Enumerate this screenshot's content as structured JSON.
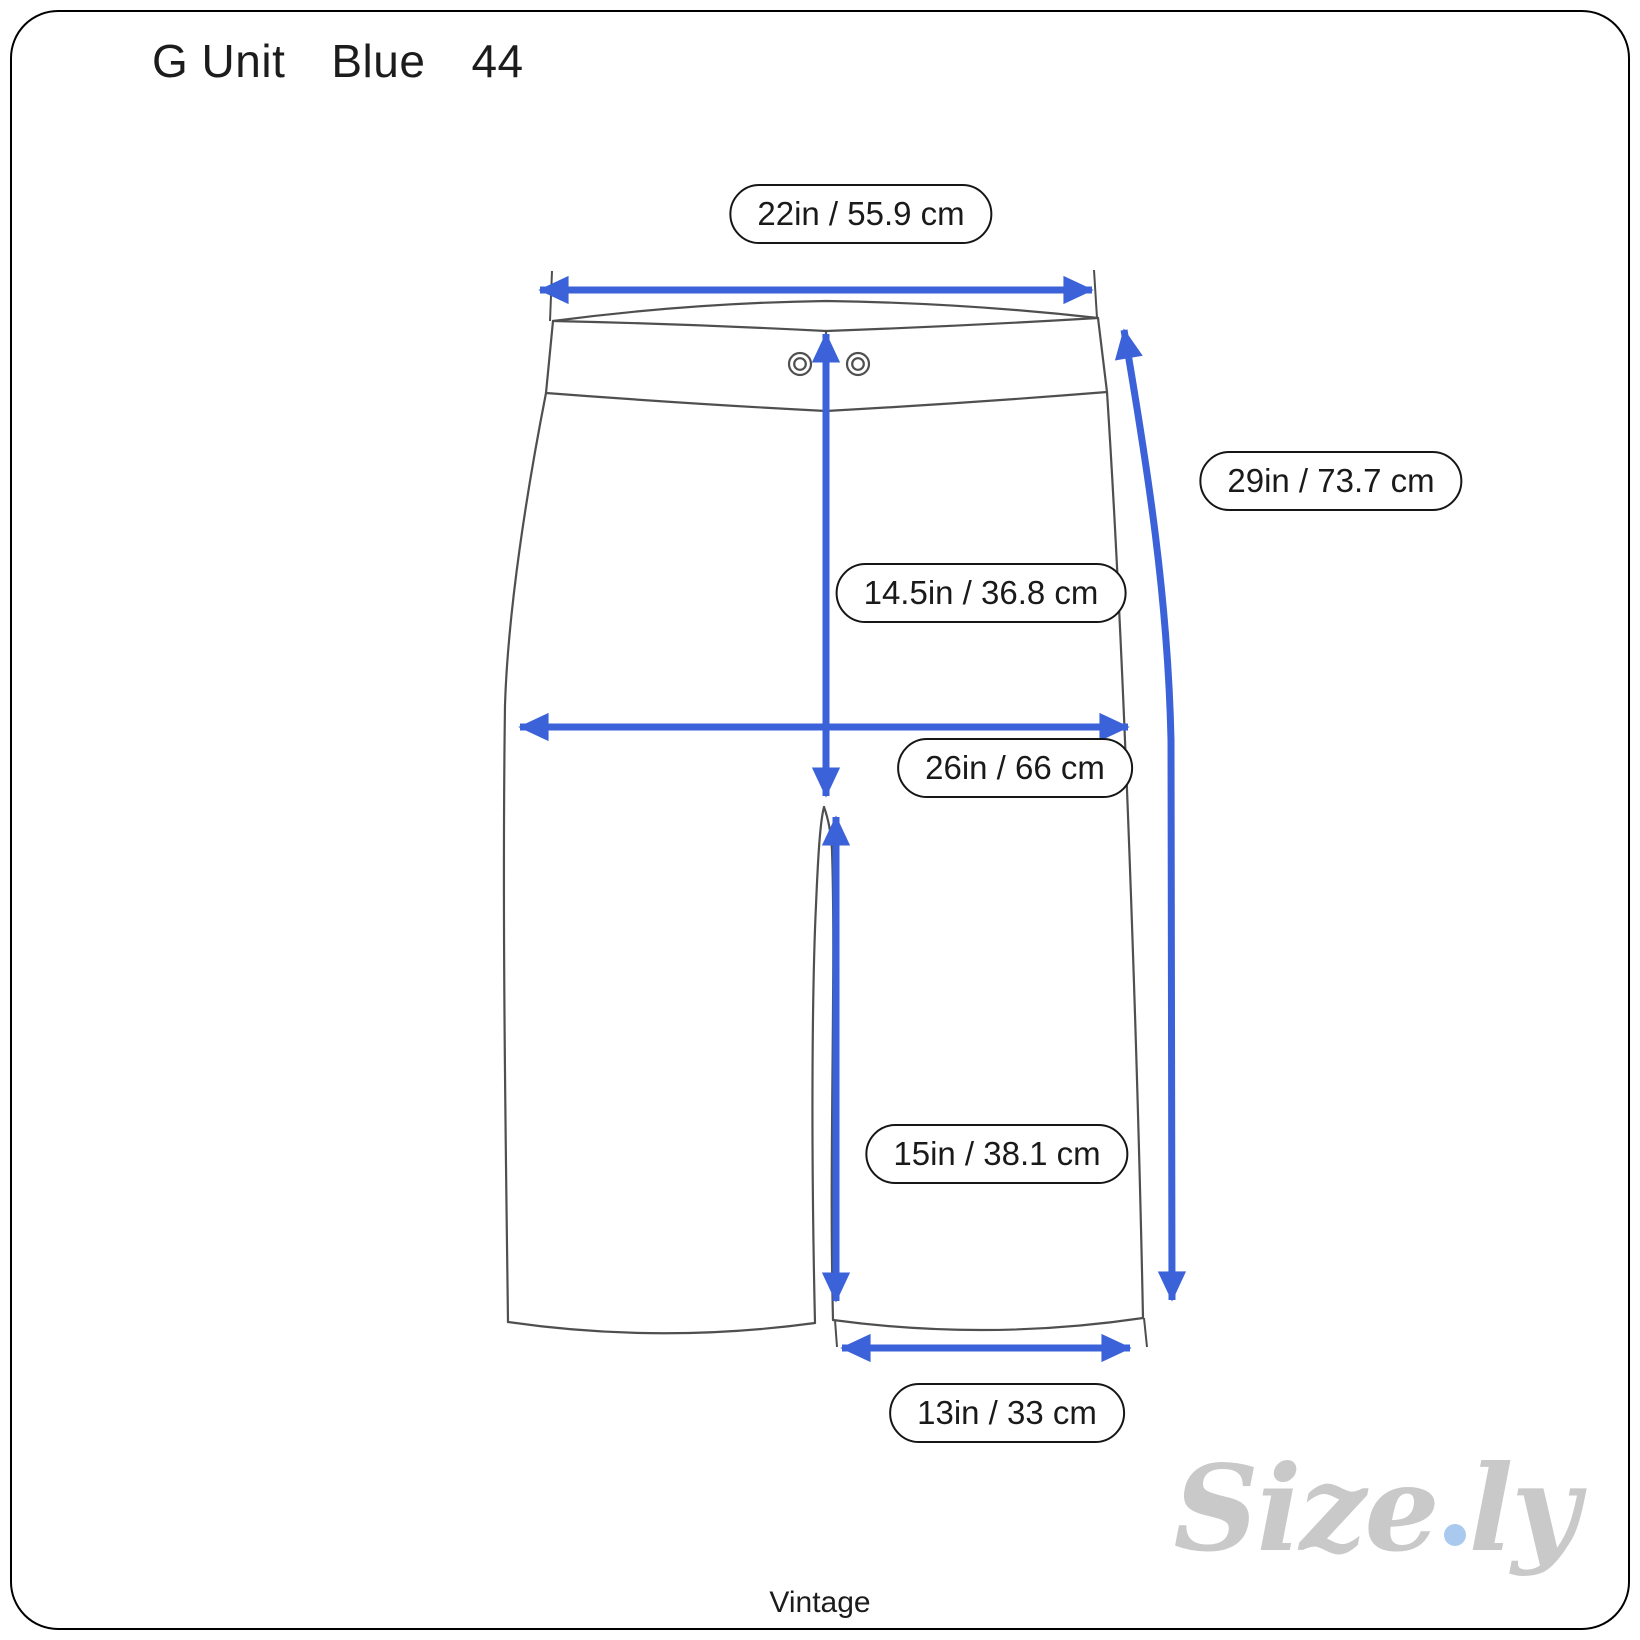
{
  "header": {
    "brand": "G Unit",
    "color": "Blue",
    "size": "44"
  },
  "measurements": {
    "waist": {
      "label": "22in / 55.9 cm",
      "inches": 22,
      "cm": 55.9
    },
    "side_length": {
      "label": "29in / 73.7 cm",
      "inches": 29,
      "cm": 73.7
    },
    "front_rise": {
      "label": "14.5in / 36.8 cm",
      "inches": 14.5,
      "cm": 36.8
    },
    "hip_width": {
      "label": "26in / 66 cm",
      "inches": 26,
      "cm": 66
    },
    "inseam": {
      "label": "15in / 38.1 cm",
      "inches": 15,
      "cm": 38.1
    },
    "leg_opening": {
      "label": "13in / 33 cm",
      "inches": 13,
      "cm": 33
    }
  },
  "footer": {
    "era_label": "Vintage"
  },
  "watermark": {
    "brand_prefix": "Size",
    "brand_suffix": "ly"
  },
  "colors": {
    "arrow_blue": "#3b62d8",
    "outline_gray": "#4f4f4f",
    "pill_border": "#161616",
    "text_dark": "#1c1c1c",
    "watermark_gray": "#c9c9c9",
    "watermark_dot_blue": "#a9c9ef"
  }
}
